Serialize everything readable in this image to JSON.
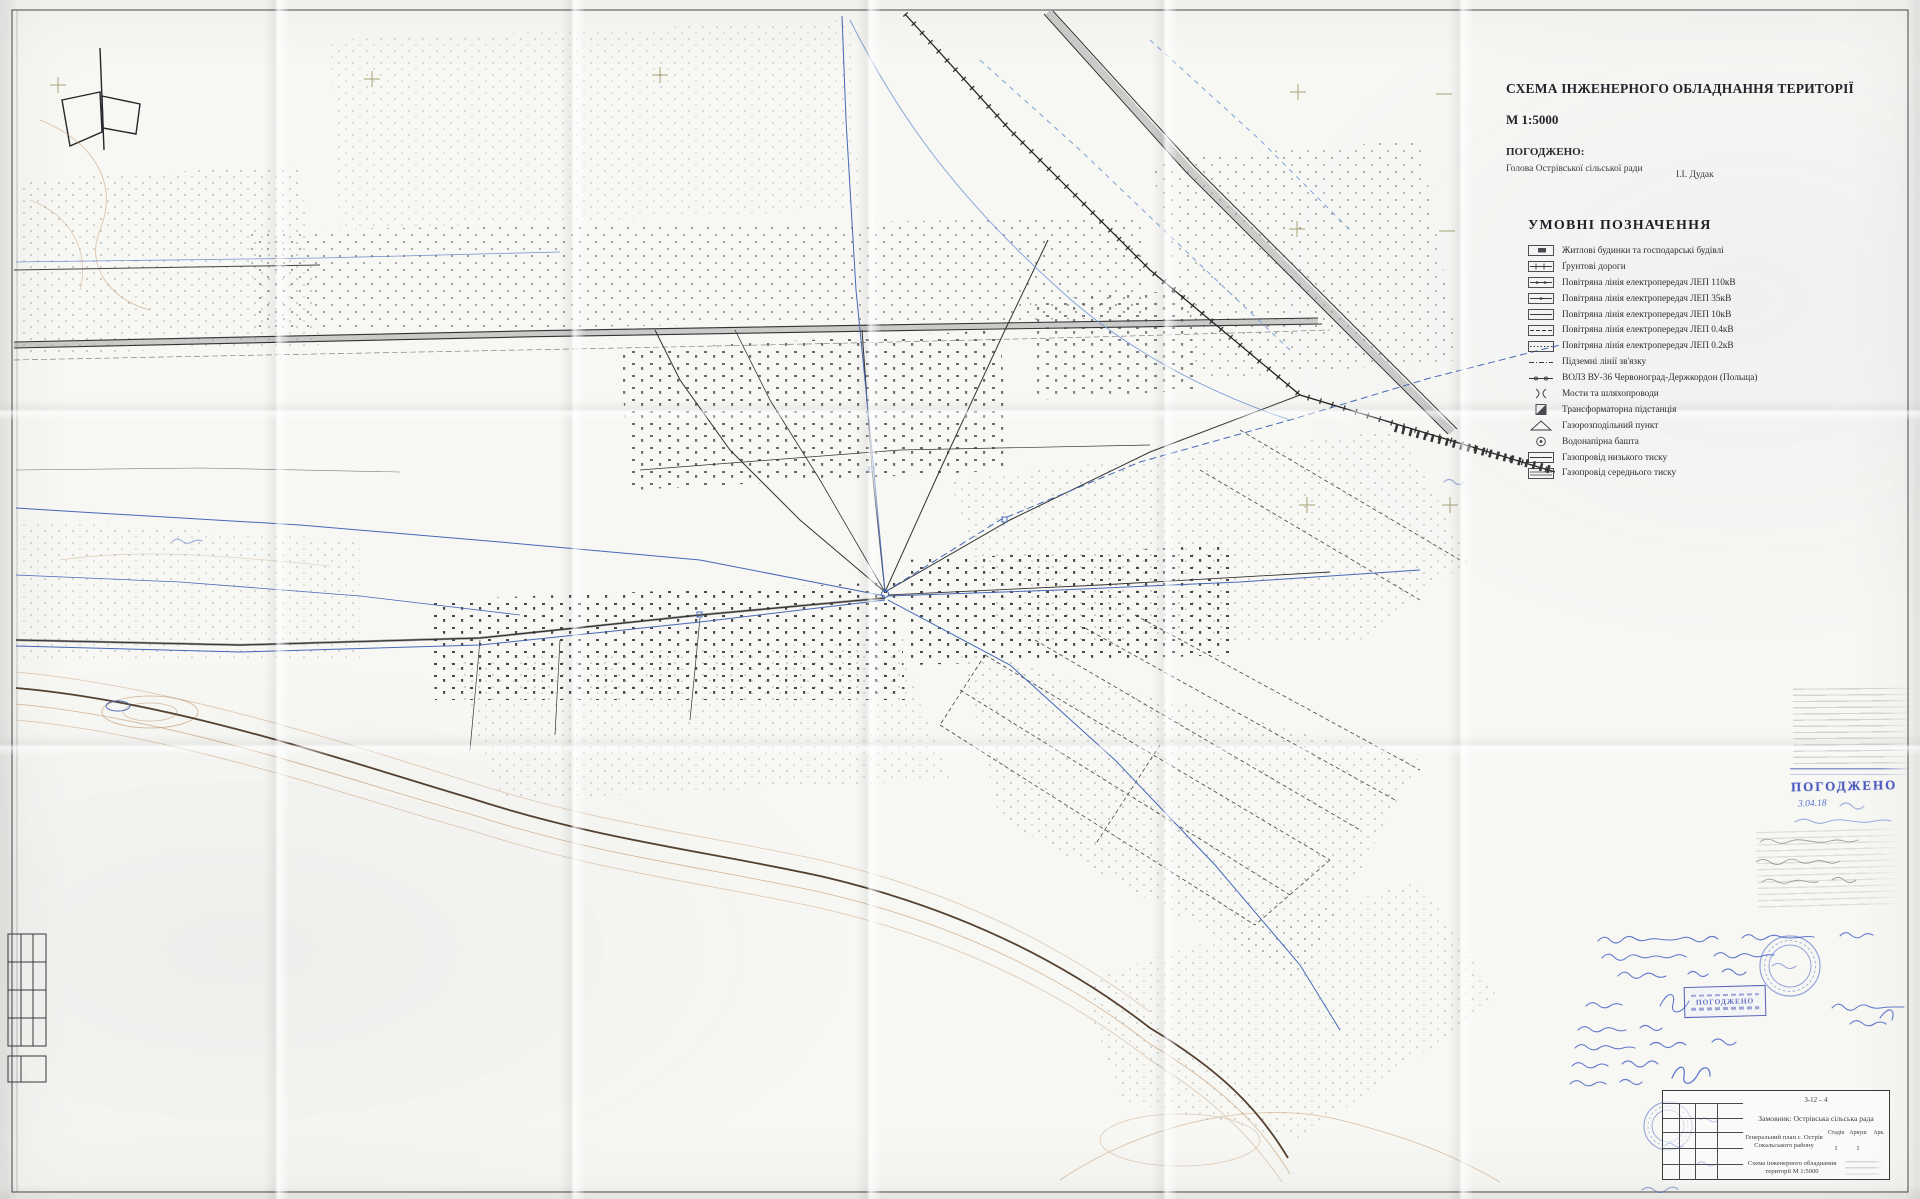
{
  "header": {
    "title": "СХЕМА ІНЖЕНЕРНОГО ОБЛАДНАННЯ ТЕРИТОРІЇ",
    "scale": "М 1:5000"
  },
  "approval": {
    "heading": "ПОГОДЖЕНО:",
    "role": "Голова Острівської сільської ради",
    "name": "І.І. Дудак"
  },
  "legend": {
    "heading": "УМОВНІ ПОЗНАЧЕННЯ",
    "items": [
      {
        "symbol": "buildings",
        "label": "Житлові будинки та господарські будівлі"
      },
      {
        "symbol": "dirt-road",
        "label": "Ґрунтові дороги"
      },
      {
        "symbol": "power-line-110kv",
        "label": "Повітряна лінія електропередач ЛЕП 110кВ"
      },
      {
        "symbol": "power-line-35kv",
        "label": "Повітряна лінія електропередач ЛЕП 35кВ"
      },
      {
        "symbol": "power-line-10kv",
        "label": "Повітряна лінія електропередач ЛЕП 10кВ"
      },
      {
        "symbol": "power-line-04kv",
        "label": "Повітряна лінія електропередач ЛЕП 0.4кВ"
      },
      {
        "symbol": "power-line-02kv",
        "label": "Повітряна лінія електропередач ЛЕП 0.2кВ"
      },
      {
        "symbol": "underground-comm",
        "label": "Підземні лінії зв'язку"
      },
      {
        "symbol": "fiber-optic",
        "label": "ВОЛЗ ВУ-36 Червоноград-Держкордон (Польща)"
      },
      {
        "symbol": "bridges",
        "label": "Мости та шляхопроводи"
      },
      {
        "symbol": "transformer",
        "label": "Трансформаторна підстанція"
      },
      {
        "symbol": "gas-point",
        "label": "Газорозподільний пункт"
      },
      {
        "symbol": "water-tower",
        "label": "Водонапірна башта"
      },
      {
        "symbol": "gas-low",
        "label": "Газопровід низького тиску"
      },
      {
        "symbol": "gas-medium",
        "label": "Газопровід середнього тиску"
      }
    ]
  },
  "annotations": {
    "stamp1_label": "ПОГОДЖЕНО",
    "stamp1_date": "3.04.18",
    "stamp2_label": "ПОГОДЖЕНО"
  },
  "title_block": {
    "doc_number": "З-12 – 4",
    "client": "Замовник: Острівська сільська рада",
    "project": "Генеральний план с. Острів Сокальського району",
    "stage_label": "Стадія",
    "sheet_label": "Аркуш",
    "sheets_label": "Арк.",
    "stage_value": "1",
    "sheet_value": "1",
    "sheet_title": "Схема інженерного обладнання території М 1:5000"
  },
  "colors": {
    "ink": "#2e2e36",
    "utility_blue": "#4668b8",
    "stamp_blue": "#3040b5",
    "contour_tan": "#c49a6c",
    "paper": "#f7f7f4"
  }
}
